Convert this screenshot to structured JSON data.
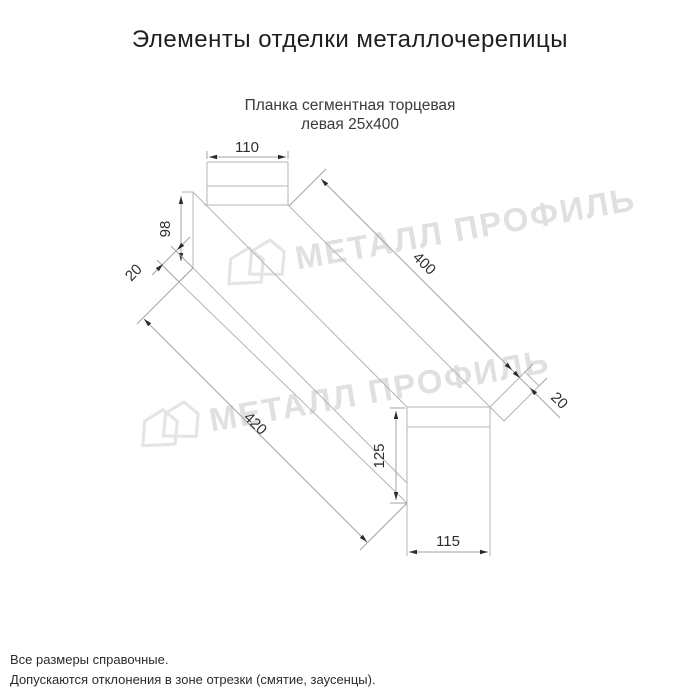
{
  "header": {
    "title": "Элементы отделки металлочерепицы"
  },
  "product": {
    "name_line1": "Планка сегментная торцевая",
    "name_line2": "левая 25х400"
  },
  "drawing": {
    "type": "technical-dimension-drawing",
    "dimensions": {
      "top_width": "110",
      "far_end_height": "98",
      "far_end_fold": "20",
      "length_top_edge": "400",
      "near_end_fold": "20",
      "length_bottom_edge": "420",
      "near_end_height": "125",
      "near_end_width": "115"
    },
    "watermark": {
      "text": "МЕТАЛЛ ПРОФИЛЬ",
      "logo": "metal-profil-house-logo"
    },
    "colors": {
      "outline": "#b5b5b5",
      "dimension_line": "#a3a3a3",
      "arrow": "#2b2b2b",
      "dimension_text": "#2e2e2e",
      "watermark": "#e0e0e0",
      "background": "#ffffff"
    }
  },
  "footer": {
    "note1": "Все размеры справочные.",
    "note2": "Допускаются отклонения в зоне отрезки (смятие, заусенцы)."
  }
}
